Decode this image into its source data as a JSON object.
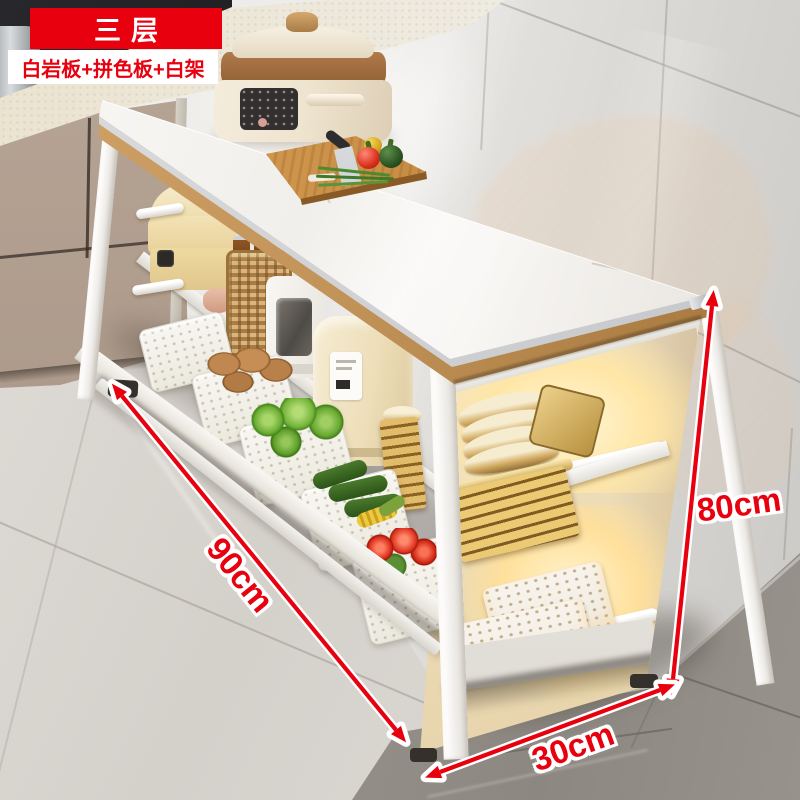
{
  "product_badges": {
    "tier_badge": "三层",
    "materials_badge": "白岩板+拼色板+白架"
  },
  "dimension_labels": {
    "height": "80cm",
    "length": "90cm",
    "depth": "30cm"
  },
  "accent_colors": {
    "badge_red": "#e8000f",
    "badge_text_white": "#ffffff",
    "dimension_label_red": "#e8000f",
    "dimension_label_outline": "#ffffff",
    "wood_trim": "#b9854a",
    "marble_white": "#f6f4f1",
    "shelf_glow_warm": "#ffd98d"
  },
  "icons": [
    {
      "name": "height-arrow-icon",
      "marks": "80cm vertical dimension"
    },
    {
      "name": "length-arrow-icon",
      "marks": "90cm diagonal dimension"
    },
    {
      "name": "depth-arrow-icon",
      "marks": "30cm depth dimension"
    }
  ]
}
